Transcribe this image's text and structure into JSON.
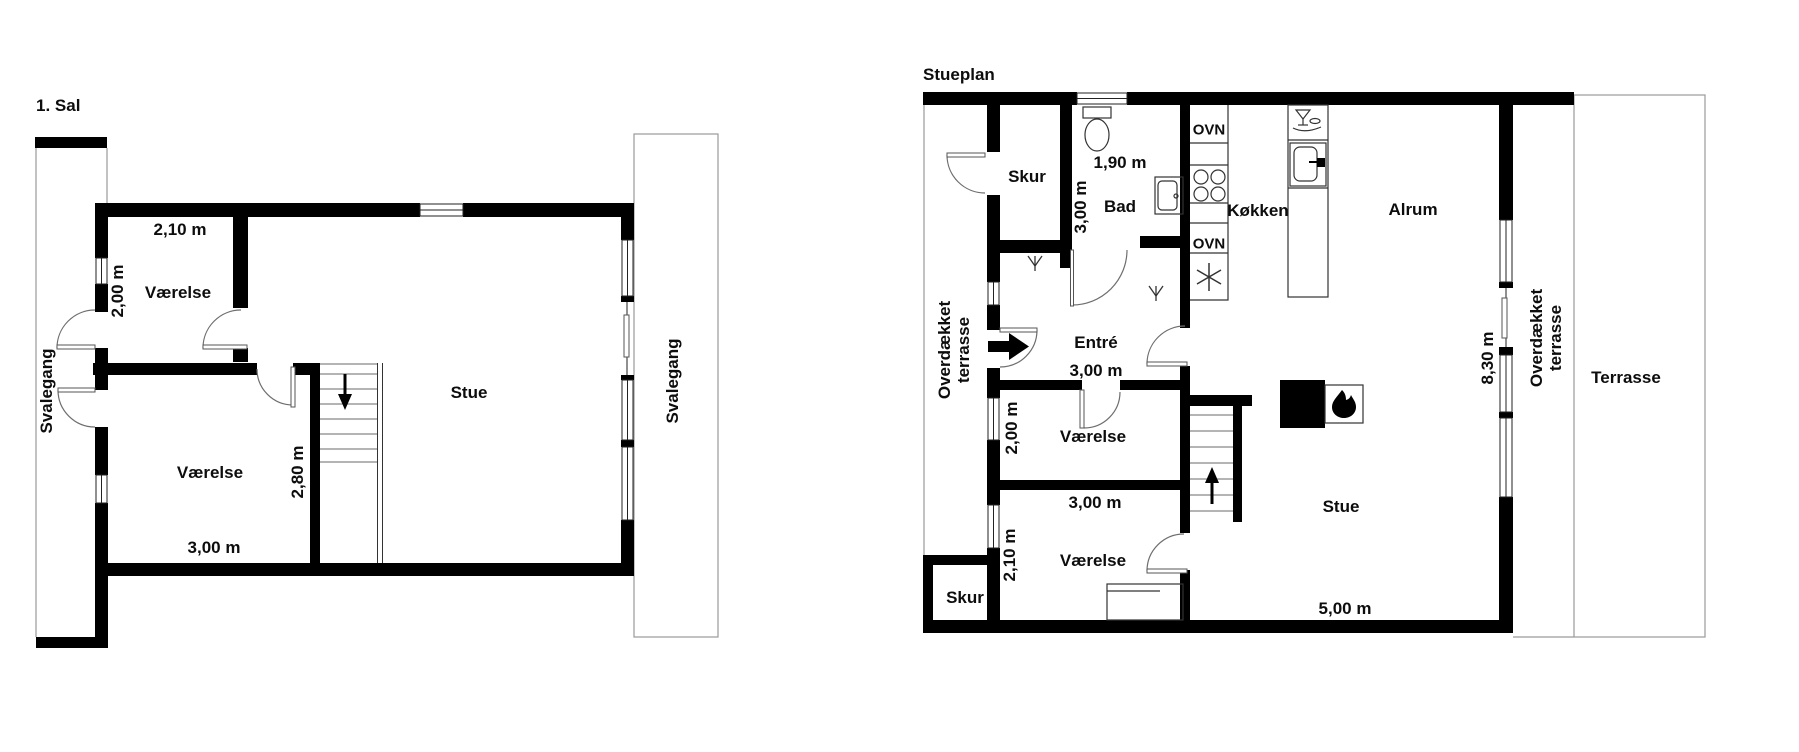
{
  "first_floor": {
    "title": "1. Sal",
    "svalegang_left": "Svalegang",
    "svalegang_right": "Svalegang",
    "room_top": {
      "name": "Værelse",
      "width": "2,10 m",
      "depth": "2,00 m"
    },
    "room_bottom": {
      "name": "Værelse",
      "width": "3,00 m",
      "depth": "2,80 m"
    },
    "stue": "Stue"
  },
  "ground_floor": {
    "title": "Stueplan",
    "skur_top": "Skur",
    "skur_bottom": "Skur",
    "bad": {
      "name": "Bad",
      "width": "1,90 m",
      "depth": "3,00 m"
    },
    "kokken": "Køkken",
    "oven_top": "OVN",
    "oven_bottom": "OVN",
    "alrum": "Alrum",
    "entre": {
      "name": "Entré",
      "width": "3,00 m"
    },
    "room_mid": {
      "name": "Værelse",
      "depth": "2,00 m",
      "width": "3,00 m"
    },
    "room_bottom": {
      "name": "Værelse",
      "depth": "2,10 m"
    },
    "stue": {
      "name": "Stue",
      "width": "5,00 m"
    },
    "house_depth": "8,30 m",
    "covered_terrace_left": {
      "line1": "Overdækket",
      "line2": "terrasse"
    },
    "covered_terrace_right": {
      "line1": "Overdækket",
      "line2": "terrasse"
    },
    "terrasse": "Terrasse"
  }
}
